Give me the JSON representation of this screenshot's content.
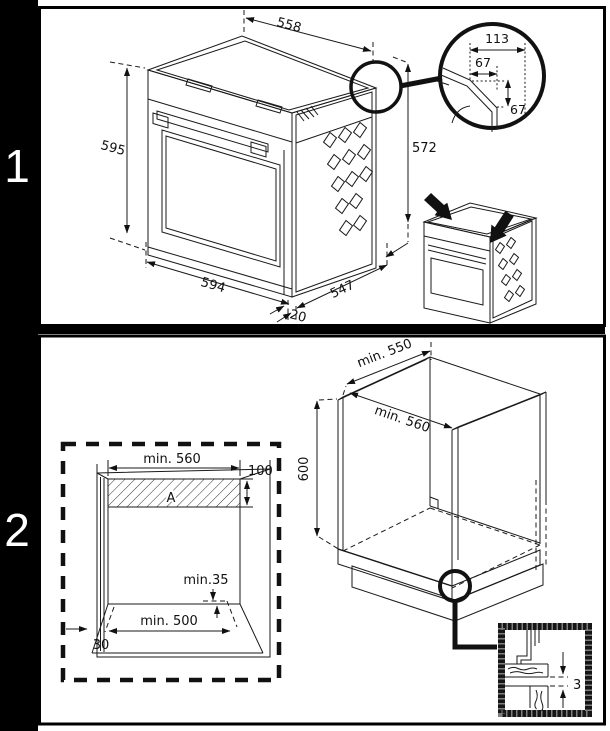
{
  "sidebar": {
    "step1": "1",
    "step2": "2"
  },
  "panel1": {
    "dims": {
      "top_depth": "558",
      "front_height": "595",
      "front_width": "594",
      "front_lip": "20",
      "body_depth": "547",
      "body_height": "572"
    },
    "corner_detail": {
      "total_width": "113",
      "offset_width": "67",
      "offset_height": "67"
    }
  },
  "panel2": {
    "cutout": {
      "top_width": "min. 560",
      "vent_area_height": "100",
      "vent_area_label": "A",
      "rear_clearance": "min.35",
      "base_width": "min. 500",
      "side_clearance": "30"
    },
    "cabinet": {
      "depth": "min. 550",
      "width": "min. 560",
      "height": "600"
    },
    "gap_detail": {
      "gap": "3"
    }
  },
  "colors": {
    "ink": "#1a1a1a",
    "paper": "#ffffff",
    "sidebar": "#000000"
  }
}
